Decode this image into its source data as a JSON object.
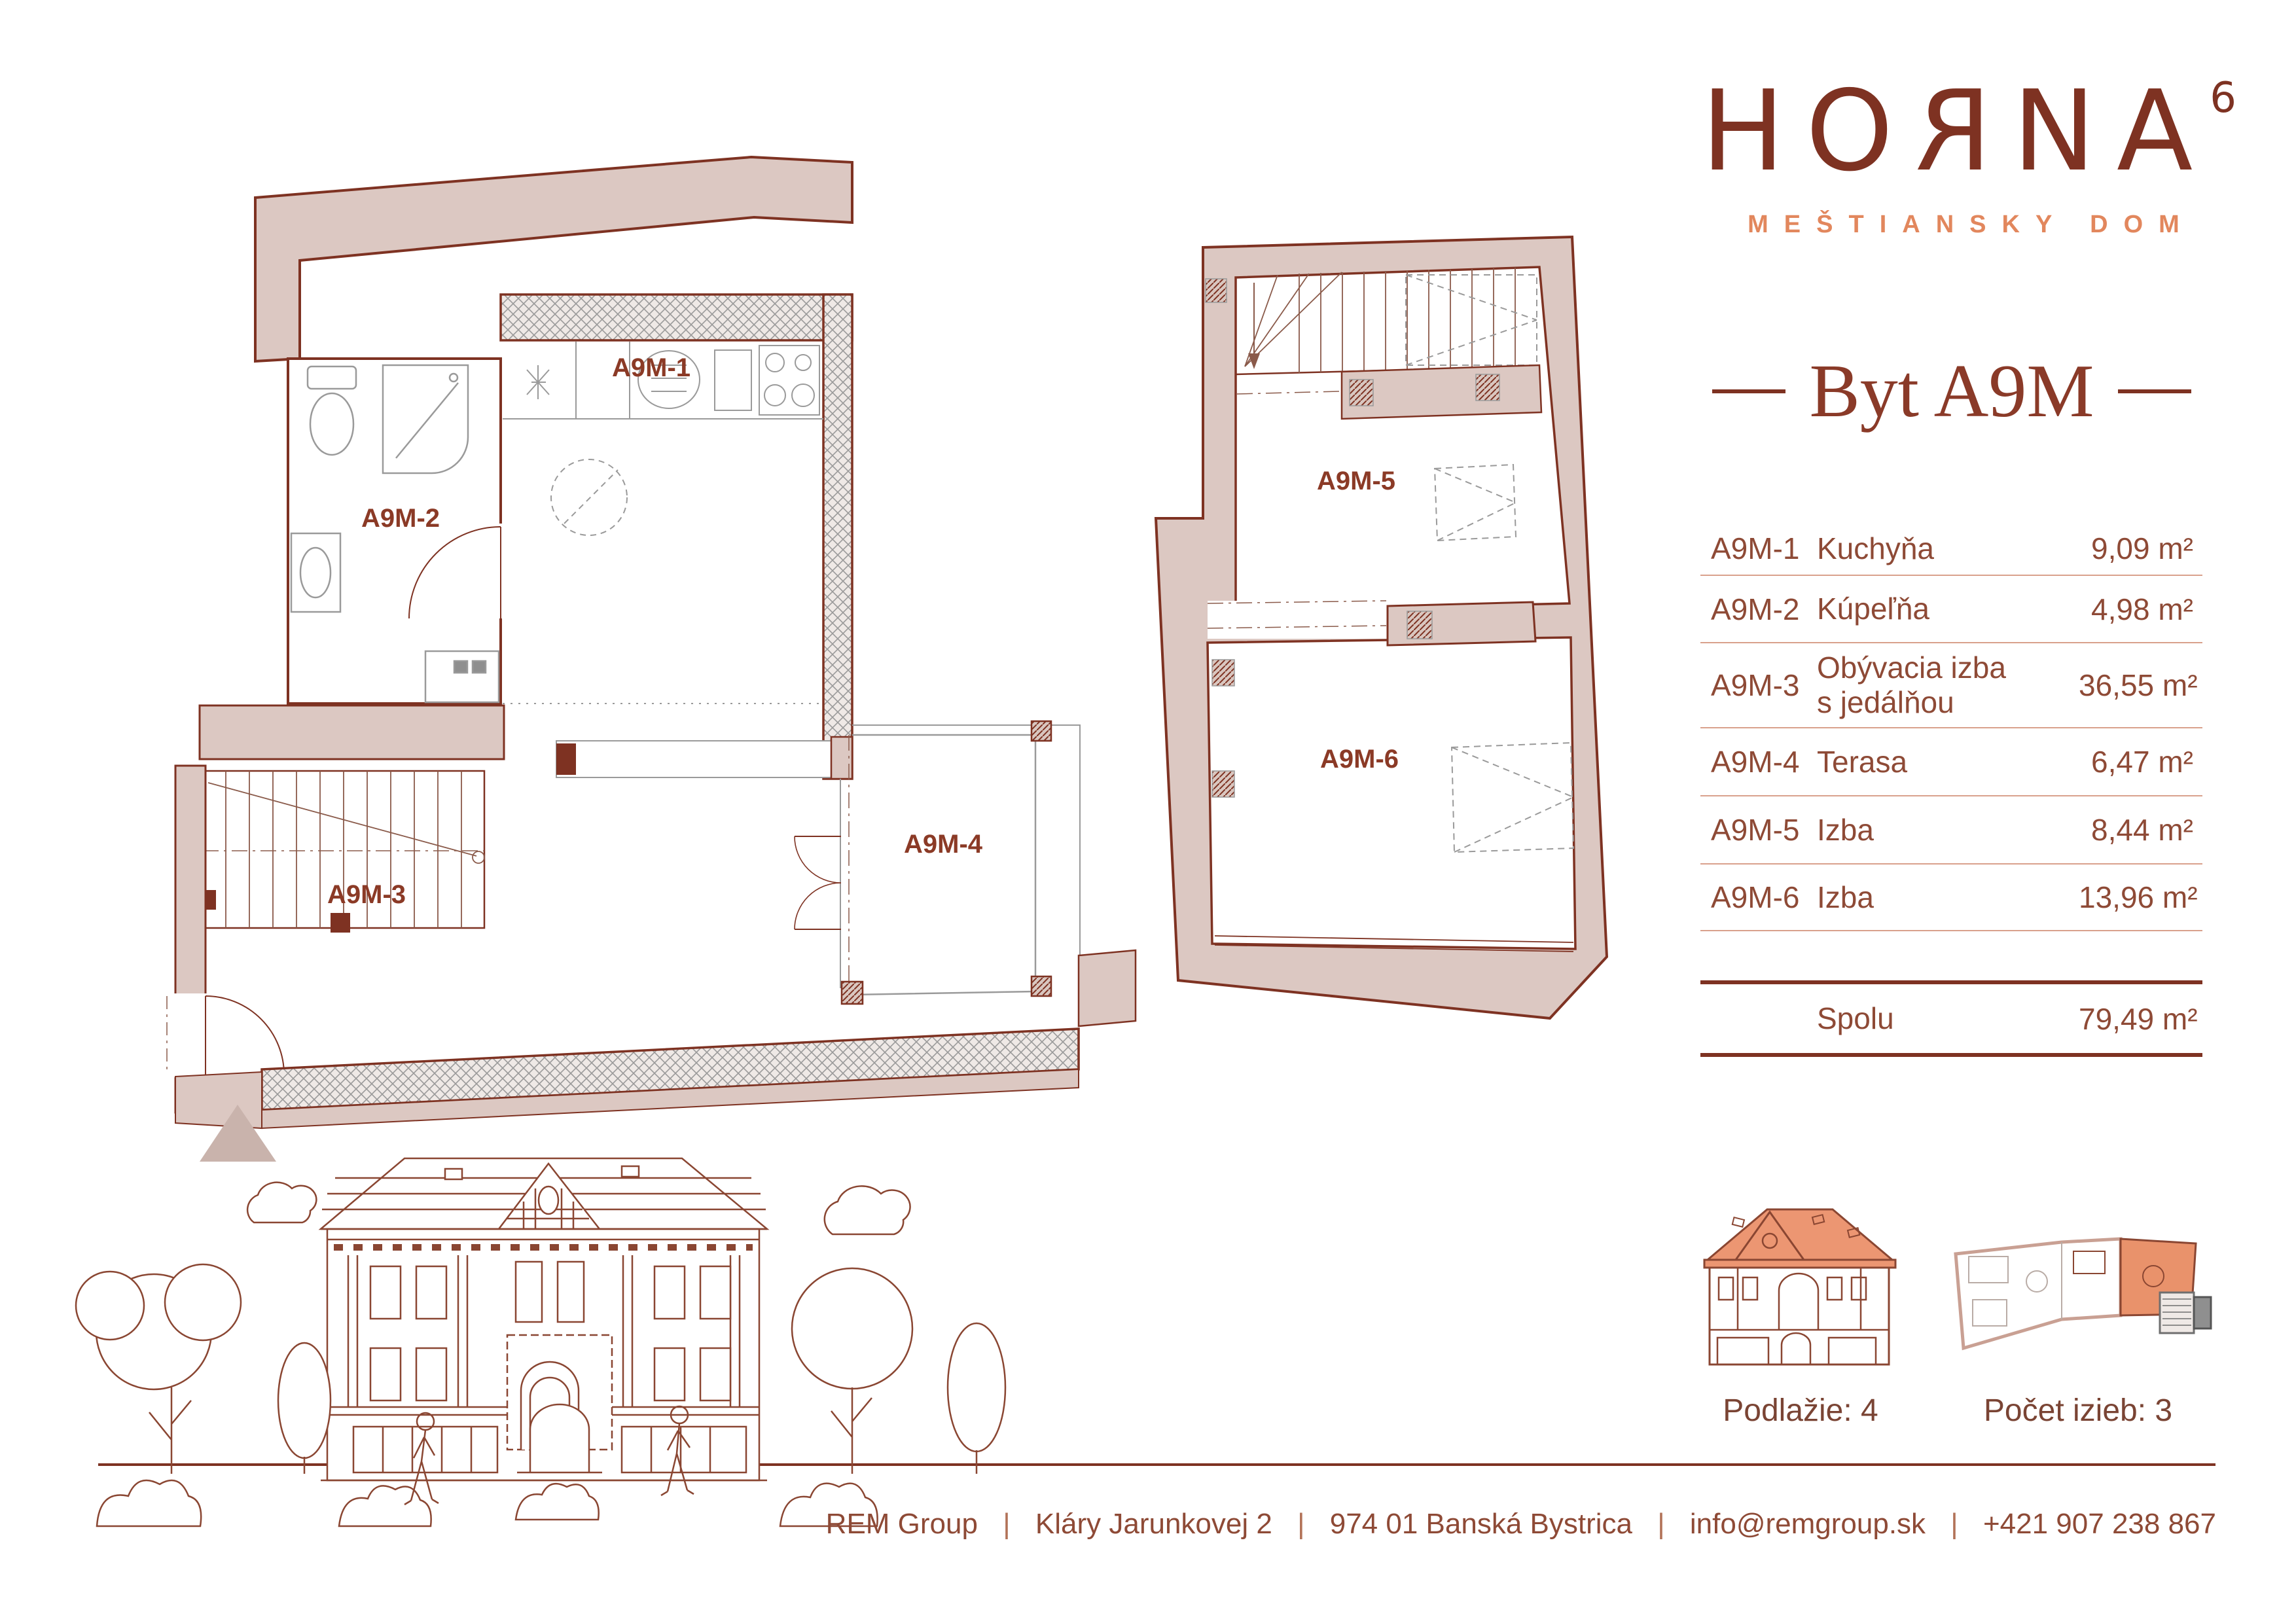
{
  "colors": {
    "dark": "#7E3222",
    "title": "#8A3A28",
    "accent": "#E2875D",
    "tabletext": "#8E4A36",
    "sep": "#D9A18C",
    "sep2": "#B27257",
    "iconlabel": "#7A4434",
    "wall_fill": "#DCC8C2",
    "label_red": "#8B3A26",
    "roof_orange": "#EC9672",
    "plan_highlight": "#E9926B",
    "hatch_gray": "#9A9A9A",
    "triangle_fill": "#C9B3AC",
    "illustration_stroke": "#8A4632"
  },
  "logo": {
    "letters": [
      "H",
      "O",
      "R",
      "N",
      "A"
    ],
    "badge": "6",
    "subtitle": "MEŠTIANSKY DOM"
  },
  "unit": {
    "title": "Byt A9M"
  },
  "table": {
    "rows": [
      {
        "code": "A9M-1",
        "name": "Kuchyňa",
        "area": "9,09 m²"
      },
      {
        "code": "A9M-2",
        "name": "Kúpeľňa",
        "area": "4,98 m²"
      },
      {
        "code": "A9M-3",
        "name": "Obývacia izba\ns jedálňou",
        "area": "36,55 m²"
      },
      {
        "code": "A9M-4",
        "name": "Terasa",
        "area": "6,47 m²"
      },
      {
        "code": "A9M-5",
        "name": "Izba",
        "area": "8,44 m²"
      },
      {
        "code": "A9M-6",
        "name": "Izba",
        "area": "13,96 m²"
      }
    ],
    "total_label": "Spolu",
    "total_area": "79,49 m²"
  },
  "plans": {
    "plan1": {
      "labels": [
        "A9M-1",
        "A9M-2",
        "A9M-3",
        "A9M-4"
      ]
    },
    "plan2": {
      "labels": [
        "A9M-5",
        "A9M-6"
      ]
    }
  },
  "summary": {
    "floor_label": "Podlažie: 4",
    "rooms_label": "Počet izieb: 3"
  },
  "footer": {
    "separator": "|",
    "parts": [
      "REM Group",
      "Kláry Jarunkovej 2",
      "974 01 Banská Bystrica",
      "info@remgroup.sk",
      "+421 907 238 867"
    ]
  }
}
